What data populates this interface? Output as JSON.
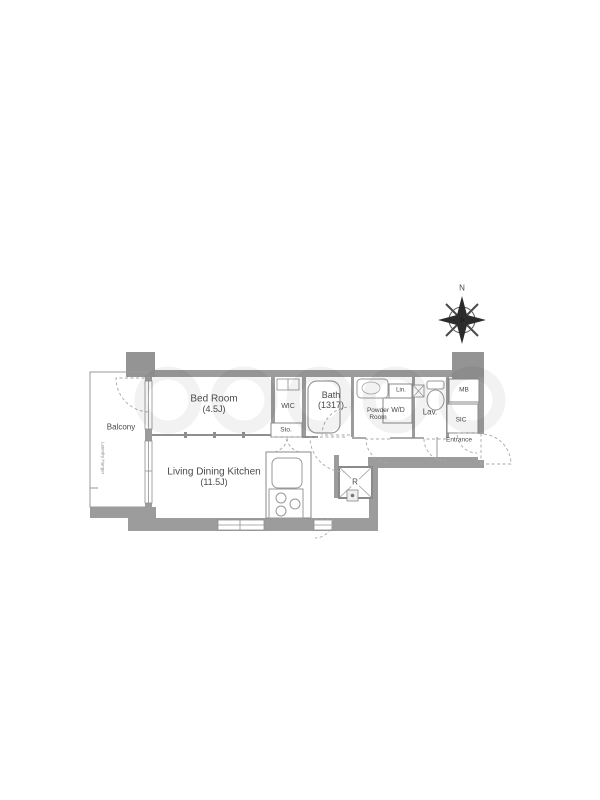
{
  "plan": {
    "compass_north": "N",
    "balcony": "Balcony",
    "laundry_hanger": "Laundry Hanger",
    "bed_room": "Bed Room",
    "bed_room_size": "(4.5J)",
    "wic": "WIC",
    "storage": "Sto.",
    "bath": "Bath",
    "bath_size": "(1317)",
    "powder_room": "Powder Room",
    "linen": "Lin.",
    "washer_dryer": "W/D",
    "lavatory": "Lav.",
    "meter_box": "MB",
    "shoe_closet": "SIC",
    "entrance": "Entrance",
    "ldk": "Living Dining Kitchen",
    "ldk_size": "(11.5J)",
    "refrigerator": "R"
  },
  "colors": {
    "wall": "#9c9c9c",
    "line": "#8f8f8f",
    "label": "#4a4a4a",
    "accent_dark": "#2b2b2b"
  }
}
